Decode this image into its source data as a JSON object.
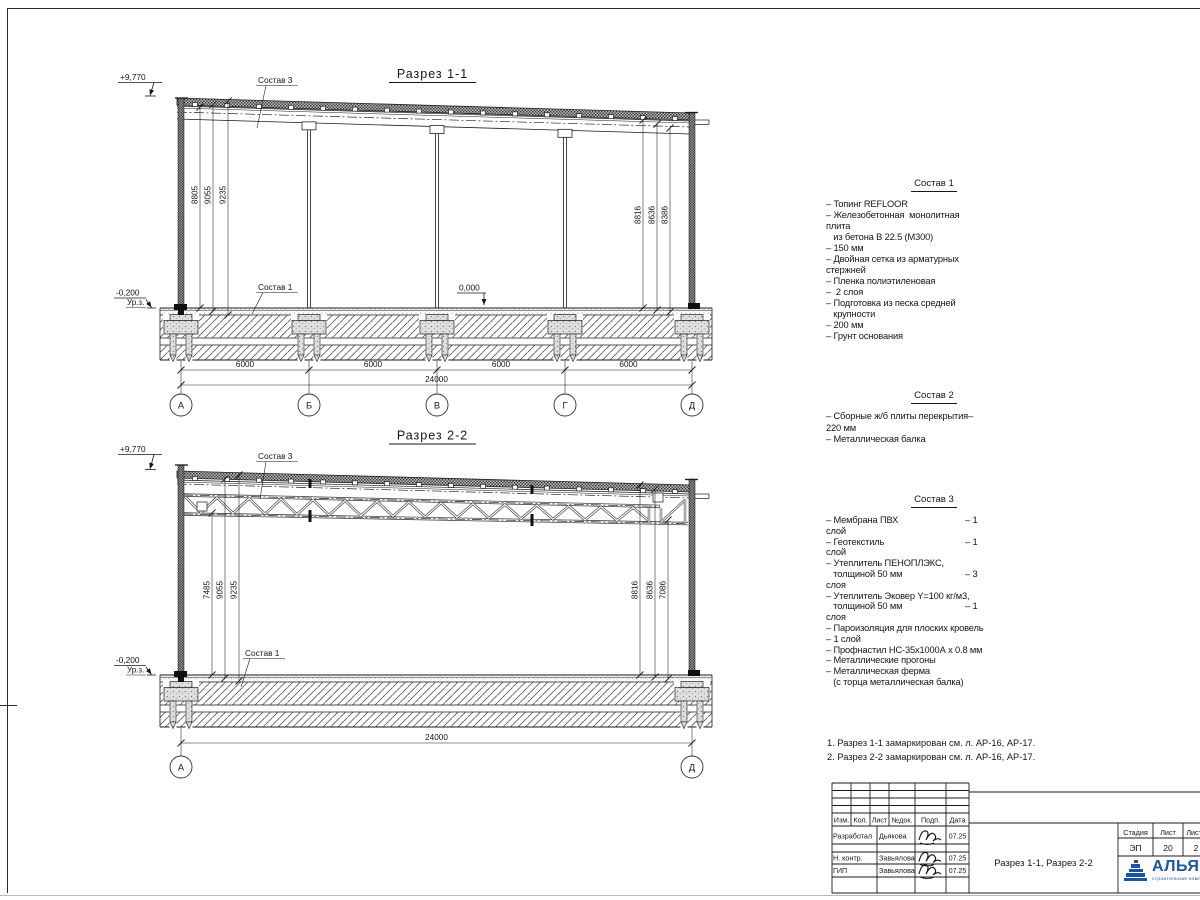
{
  "section1": {
    "title": "Разрез 1-1",
    "elevation_top": "+9,770",
    "label_top": "Состав 3",
    "label_floor": "Состав 1",
    "level_zero": "0,000",
    "level_minus": "-0,200",
    "level_ground_label": "Ур.з.",
    "dims_left": [
      "8805",
      "9055",
      "9235"
    ],
    "dims_right": [
      "8816",
      "8636",
      "8386"
    ],
    "dims_bottom": [
      "6000",
      "6000",
      "6000",
      "6000"
    ],
    "dim_total": "24000",
    "axes": [
      "А",
      "Б",
      "В",
      "Г",
      "Д"
    ]
  },
  "section2": {
    "title": "Разрез 2-2",
    "elevation_top": "+9,770",
    "label_top": "Состав 3",
    "label_floor": "Состав 1",
    "level_minus": "-0,200",
    "level_ground_label": "Ур.з.",
    "dims_left": [
      "7485",
      "9055",
      "9235"
    ],
    "dims_right": [
      "8816",
      "8636",
      "7086"
    ],
    "dim_total": "24000",
    "axes": [
      "А",
      "Д"
    ]
  },
  "compositions": [
    {
      "title": "Состав 1",
      "items": [
        {
          "l": "– Топинг REFLOOR"
        },
        {
          "l": "– Железобетонная  монолитная"
        },
        {
          "l": "плита"
        },
        {
          "l": "   из бетона В 22.5 (М300)"
        },
        {
          "l": "– 150 мм"
        },
        {
          "l": "– Двойная сетка из арматурных"
        },
        {
          "l": "стержней"
        },
        {
          "l": "– Пленка полиэтиленовая"
        },
        {
          "l": "–  2 слоя"
        },
        {
          "l": "– Подготовка из песка средней"
        },
        {
          "l": "   крупности"
        },
        {
          "l": "– 200 мм"
        },
        {
          "l": "– Грунт основания"
        }
      ]
    },
    {
      "title": "Состав 2",
      "items": [
        {
          "l": "– Сборные ж/б плиты перекрытия–"
        },
        {
          "l": "220 мм"
        },
        {
          "l": "– Металлическая балка"
        }
      ]
    },
    {
      "title": "Состав 3",
      "items": [
        {
          "l": "– Мембрана ПВХ",
          "r": "– 1"
        },
        {
          "l": "слой"
        },
        {
          "l": "– Геотекстиль",
          "r": "– 1"
        },
        {
          "l": "слой"
        },
        {
          "l": "– Утеплитель ПЕНОПЛЭКС,"
        },
        {
          "l": "   толщиной 50 мм",
          "r": "– 3"
        },
        {
          "l": "слоя"
        },
        {
          "l": "– Утеплитель Эковер Y=100 кг/м3,"
        },
        {
          "l": "   толщиной 50 мм",
          "r": "– 1"
        },
        {
          "l": "слоя"
        },
        {
          "l": "– Пароизоляция для плоских кровель"
        },
        {
          "l": "– 1 слой"
        },
        {
          "l": "– Профнастил НС-35х1000А х 0.8 мм"
        },
        {
          "l": "– Металлические прогоны"
        },
        {
          "l": "– Металлическая ферма"
        },
        {
          "l": "   (с торца металлическая балка)"
        }
      ]
    }
  ],
  "notes": [
    "1. Разрез 1-1 замаркирован см. л. АР-16, АР-17.",
    "2. Разрез 2-2 замаркирован см. л. АР-16, АР-17."
  ],
  "title_block": {
    "header_cols": [
      "Изм.",
      "Кол.",
      "Лист",
      "№док.",
      "Подп.",
      "Дата"
    ],
    "rows": [
      {
        "role": "Разработал",
        "name": "Дьякова",
        "date": "07.25"
      },
      {
        "role": "",
        "name": "",
        "date": ""
      },
      {
        "role": "Н. контр.",
        "name": "Завьялова",
        "date": "07.25"
      },
      {
        "role": "ГИП",
        "name": "Завьялова",
        "date": "07.25"
      }
    ],
    "doc_title": "Разрез 1-1, Разрез 2-2",
    "stage_cols": [
      "Стадия",
      "Лист",
      "Листов"
    ],
    "stage_vals": [
      "ЭП",
      "20",
      "2"
    ],
    "logo_text": "АЛЬЯНС",
    "logo_tagline": "строительная компания"
  },
  "colors": {
    "logo_blue": "#1a56a0",
    "line": "#1a1a1a"
  }
}
